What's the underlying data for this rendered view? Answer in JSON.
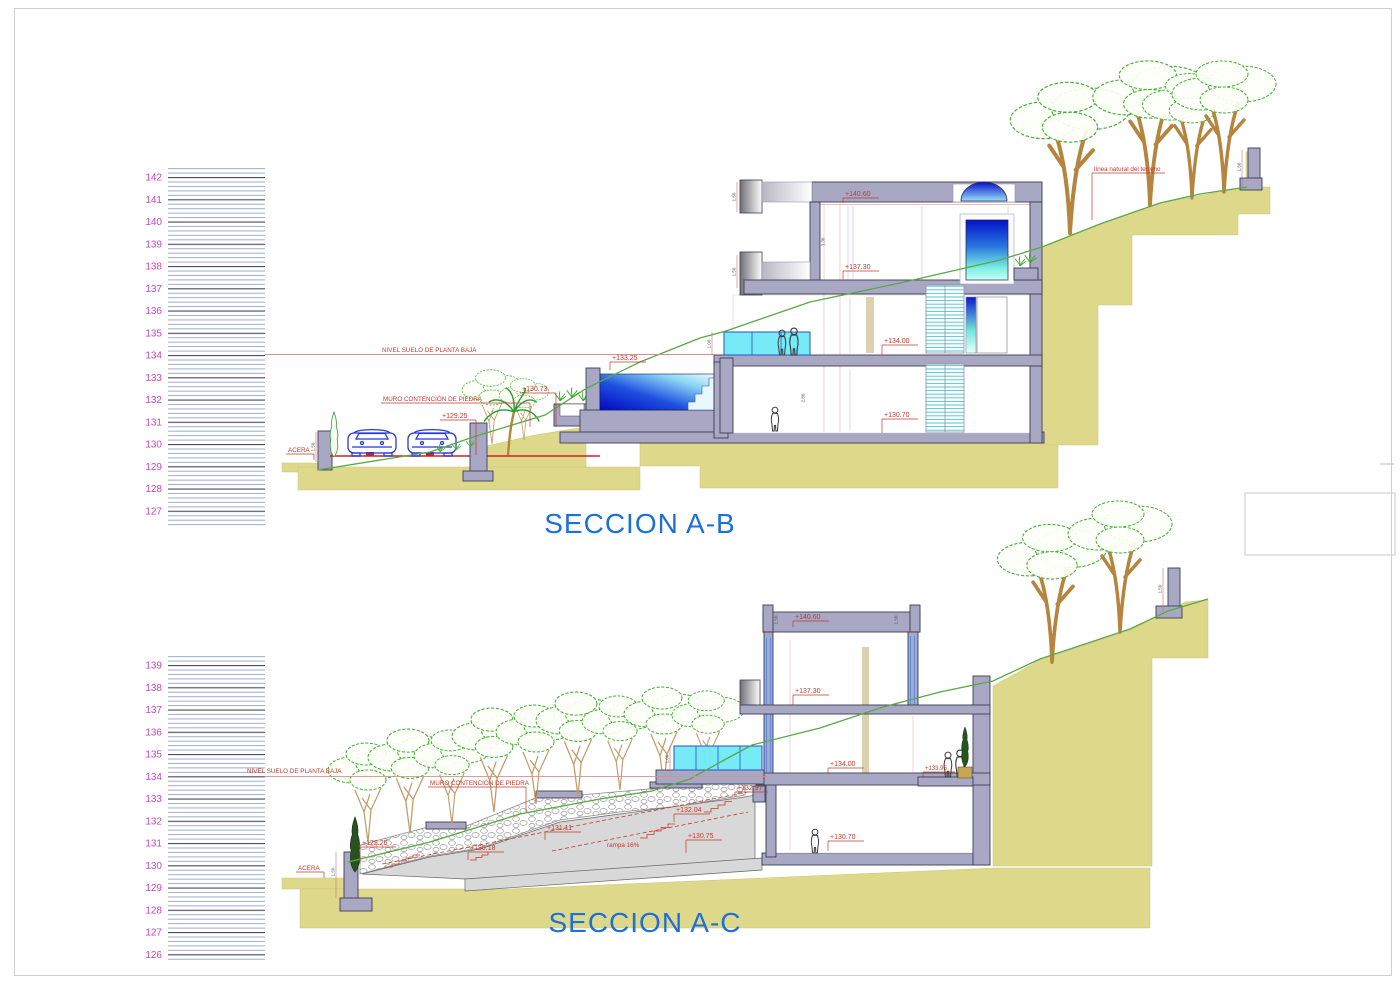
{
  "titles": {
    "section_ab": "SECCION A-B",
    "section_ac": "SECCION A-C"
  },
  "colors": {
    "title_blue": "#1c70d8",
    "annotation_red": "#c13a2e",
    "scale_magenta": "#c445c4",
    "terrain_tan": "#ded98a",
    "wall_gray": "#a8a8c4",
    "terrain_line_green": "#58a846",
    "water_blue": "#0a16c8",
    "glass_cyan": "#6fe9f6"
  },
  "section_ab": {
    "scale_numbers": [
      "142",
      "141",
      "140",
      "139",
      "138",
      "137",
      "136",
      "135",
      "134",
      "133",
      "132",
      "131",
      "130",
      "129",
      "128",
      "127"
    ],
    "labels": {
      "nivel_suelo": "NIVEL SUELO DE PLANTA BAJA",
      "muro_contencion": "MURO CONTENCIÓN DE PIEDRA",
      "acera": "ACERA",
      "linea_terreno": "línea natural del terreno"
    },
    "elevations": {
      "roof": "+140.60",
      "upper_floor": "+137.30",
      "ground_floor": "+134.00",
      "pool": "+133.25",
      "muro_top": "+130.73",
      "street": "+129.25",
      "lower_floor": "+130.70"
    },
    "dims": {
      "eave_upper": "1.50",
      "eave_lower": "1.50",
      "rail": "1.00",
      "wall_upper": "3.30",
      "wall_lower": "2.80",
      "muro": "1.50",
      "ret_wall": "1.50"
    }
  },
  "section_ac": {
    "scale_numbers": [
      "139",
      "138",
      "137",
      "136",
      "135",
      "134",
      "133",
      "132",
      "131",
      "130",
      "129",
      "128",
      "127",
      "126"
    ],
    "labels": {
      "nivel_suelo": "NIVEL SUELO DE PLANTA BAJA",
      "muro_contencion": "MURO CONTENCIÓN DE PIEDRA",
      "acera": "ACERA",
      "rampa": "rampa 16%"
    },
    "elevations": {
      "roof": "+140.60",
      "upper_floor": "+137.30",
      "ground_floor": "+134.00",
      "terrace": "+133.95",
      "stair_top": "+132.97",
      "stair_3": "+132.04",
      "stair_2": "+131.11",
      "stair_1": "+130.18",
      "street": "+129.25",
      "ramp_mid": "+130.75",
      "lower_floor": "+130.70"
    },
    "dims": {
      "parapet_left": "1.50",
      "parapet_right": "1.50",
      "glass": "1.00",
      "wall_street": "1.50",
      "ret_wall": "1.50"
    }
  }
}
